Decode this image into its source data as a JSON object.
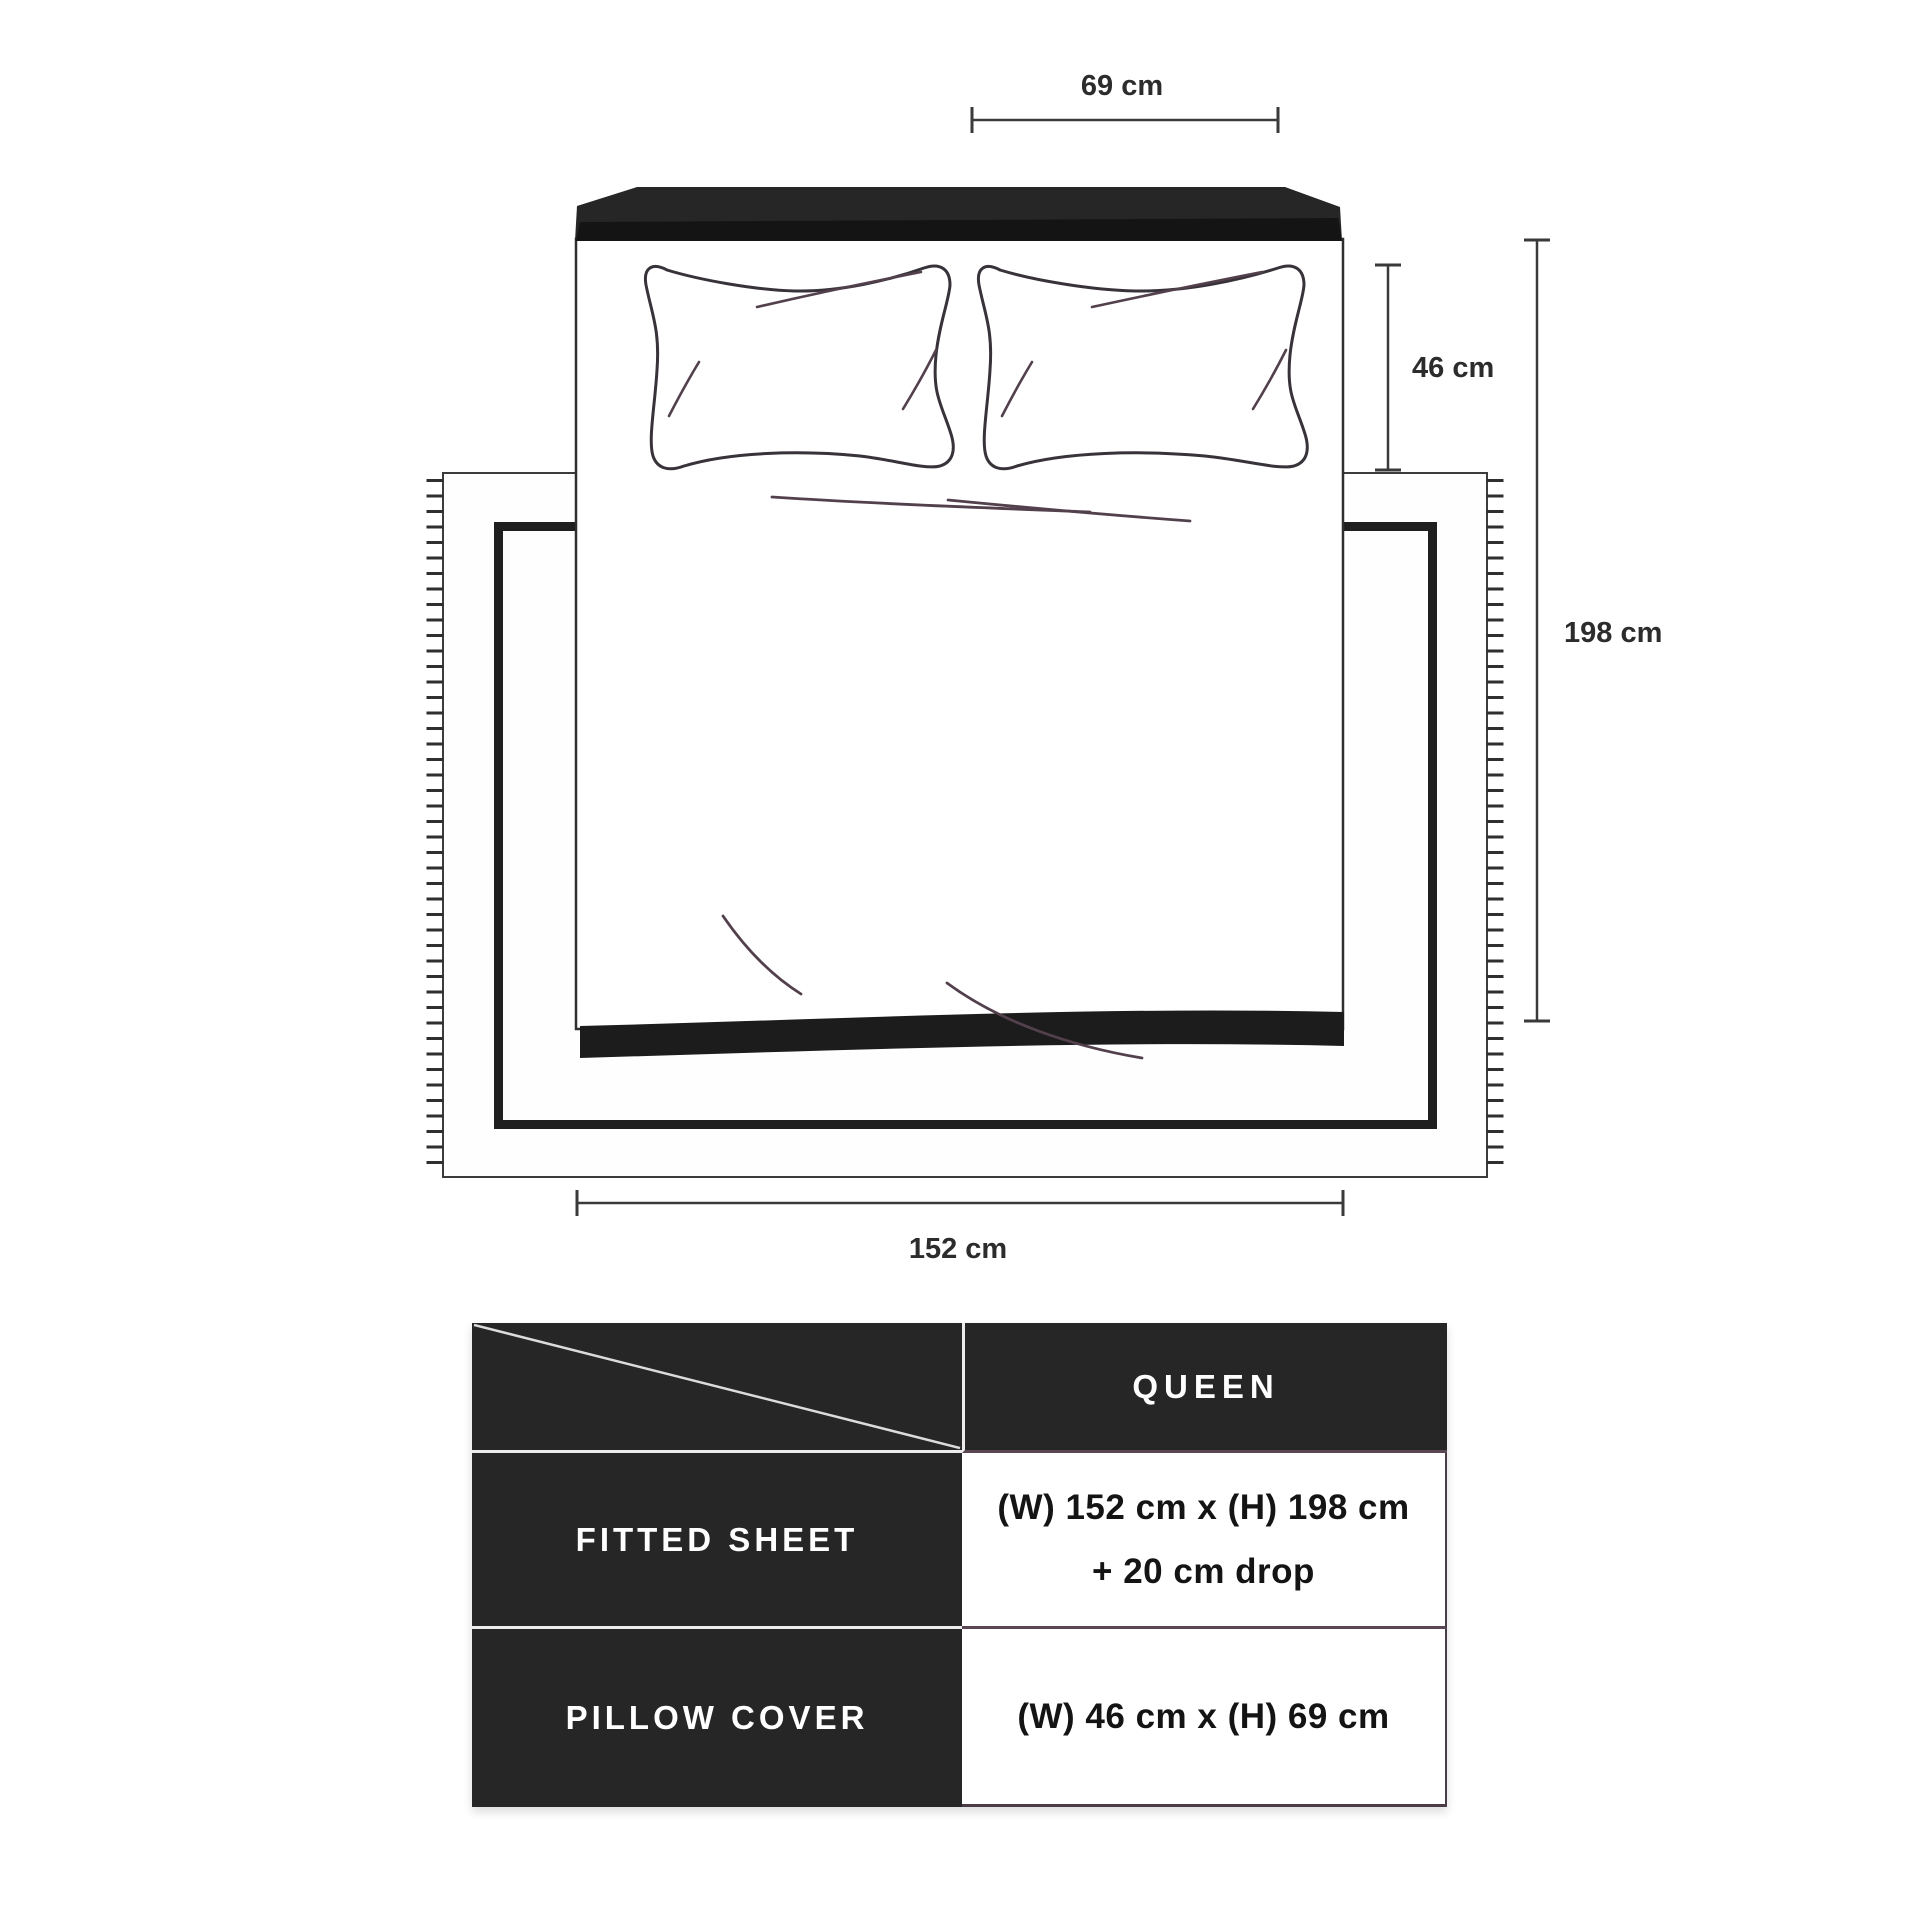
{
  "diagram": {
    "dimension_labels": {
      "pillow_width": "69 cm",
      "pillow_height": "46 cm",
      "bed_length": "198 cm",
      "bed_width": "152 cm"
    }
  },
  "size_table": {
    "column_header": "QUEEN",
    "rows": [
      {
        "label": "FITTED SHEET",
        "value_line1": "(W) 152 cm x (H) 198 cm",
        "value_line2": "+ 20 cm drop"
      },
      {
        "label": "PILLOW COVER",
        "value_line1": "(W) 46 cm x (H) 69 cm",
        "value_line2": ""
      }
    ]
  },
  "colors": {
    "dark_panel": "#262626",
    "headboard_shadow": "#141414",
    "outline": "#3a3a3a",
    "crease": "#53404d",
    "table_divider_light": "#ececec",
    "table_divider_dark": "#493c46",
    "text_dark": "#141414",
    "text_light": "#ffffff"
  }
}
